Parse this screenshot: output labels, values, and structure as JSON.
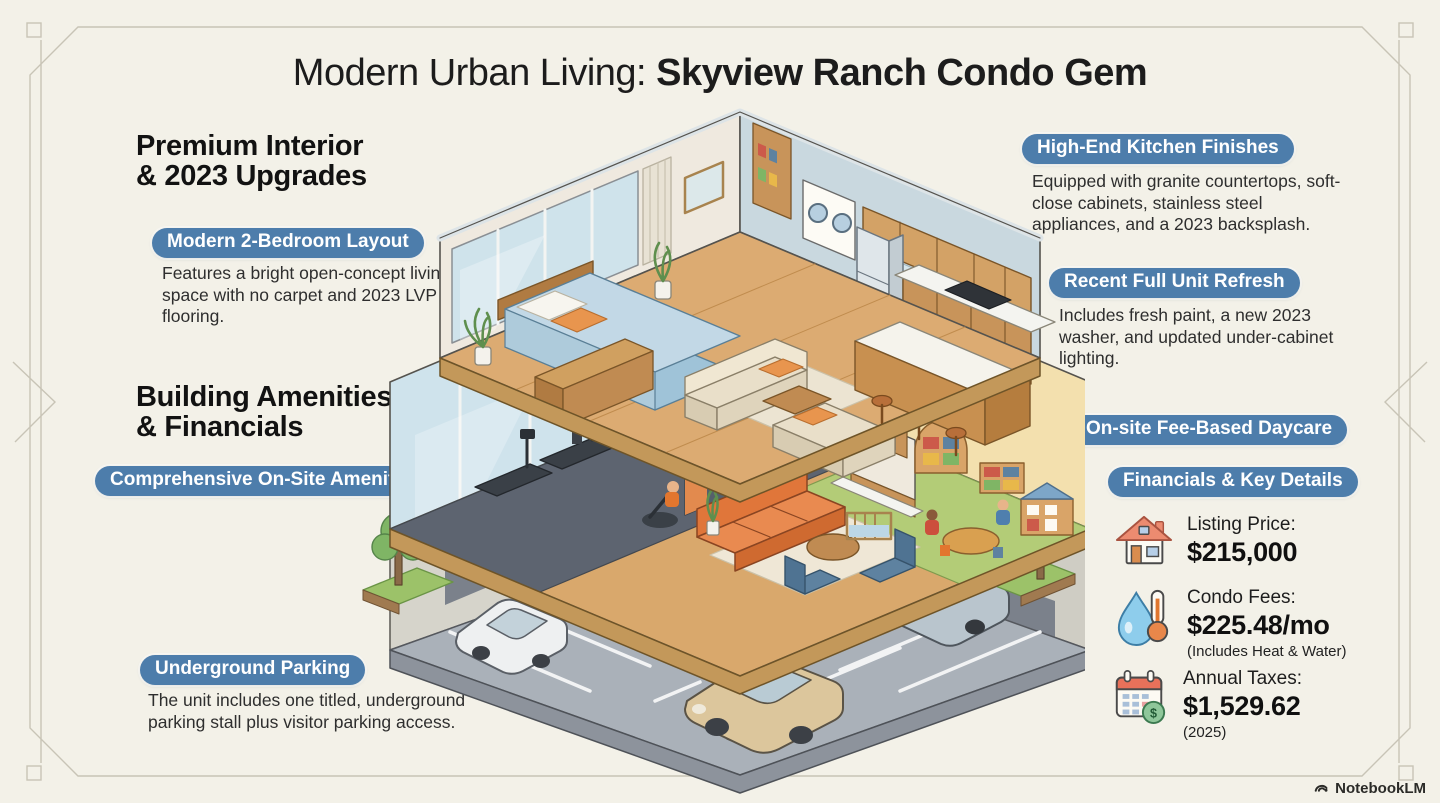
{
  "title": {
    "regular": "Modern Urban Living:",
    "bold": "Skyview Ranch Condo Gem"
  },
  "left": {
    "premium": {
      "line1": "Premium Interior",
      "line2": "& 2023 Upgrades",
      "badge": "Modern 2-Bedroom Layout",
      "body": "Features a bright open-concept living space with no carpet and 2023 LVP flooring."
    },
    "amenities": {
      "line1": "Building Amenities",
      "line2": "& Financials",
      "badge": "Comprehensive On-Site Amenities"
    },
    "parking": {
      "badge": "Underground Parking",
      "body": "The unit includes one titled, underground parking stall plus visitor parking access."
    }
  },
  "right": {
    "kitchen": {
      "badge": "High-End Kitchen Finishes",
      "body": "Equipped with granite countertops, soft-close cabinets, stainless steel appliances, and a 2023 backsplash."
    },
    "refresh": {
      "badge": "Recent Full Unit Refresh",
      "body": "Includes fresh paint, a new 2023 washer, and updated under-cabinet lighting."
    },
    "daycare": {
      "badge": "On-site Fee-Based Daycare"
    },
    "financials": {
      "badge": "Financials & Key Details",
      "items": [
        {
          "icon": "house-icon",
          "label": "Listing Price:",
          "value": "$215,000",
          "note": ""
        },
        {
          "icon": "water-thermometer-icon",
          "label": "Condo Fees:",
          "value": "$225.48/mo",
          "note": "(Includes Heat & Water)"
        },
        {
          "icon": "calendar-dollar-icon",
          "label": "Annual Taxes:",
          "value": "$1,529.62",
          "note": "(2025)"
        }
      ]
    }
  },
  "footer": {
    "brand": "NotebookLM"
  },
  "colors": {
    "accent_blue": "#4d7dab",
    "background": "#f3f1e8",
    "text_dark": "#1c1c1c"
  }
}
